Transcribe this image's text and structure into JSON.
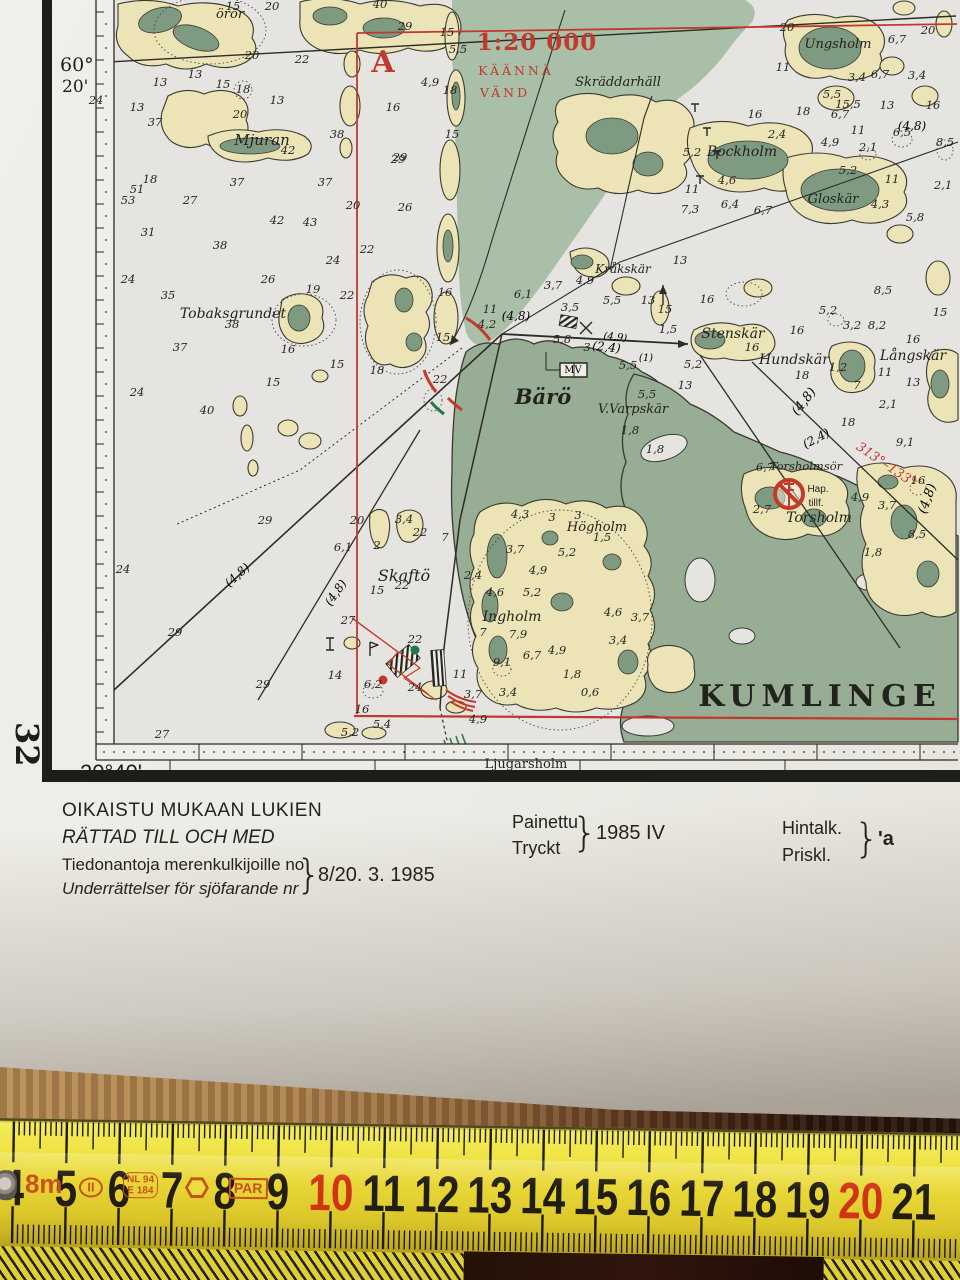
{
  "colors": {
    "chart_red": "#c0392e",
    "mark_red": "#c23b2a",
    "mark_green": "#1e7a4a",
    "land_cream": "#ece4b6",
    "shallow_green": "#a9bfa7",
    "land_green": "#97ae95",
    "tape_yellow": "#eedd3a"
  },
  "frame": {
    "lat_deg": "60°",
    "lat_min": "20'",
    "lon": "20°40'",
    "sheet": "32"
  },
  "map": {
    "places": [
      {
        "t": "örör",
        "x": 230,
        "y": 18,
        "s": 13
      },
      {
        "t": "Mjuran",
        "x": 262,
        "y": 145,
        "s": 15
      },
      {
        "t": "Tobaksgrundet",
        "x": 233,
        "y": 318,
        "s": 14
      },
      {
        "t": "Skräddarhäll",
        "x": 618,
        "y": 86,
        "s": 13
      },
      {
        "t": "Ungsholm",
        "x": 838,
        "y": 48,
        "s": 13
      },
      {
        "t": "Bockholm",
        "x": 742,
        "y": 156,
        "s": 14
      },
      {
        "t": "Gloskär",
        "x": 833,
        "y": 203,
        "s": 13
      },
      {
        "t": "Kråkskär",
        "x": 623,
        "y": 273,
        "s": 12
      },
      {
        "t": "Stenskär",
        "x": 733,
        "y": 338,
        "s": 14
      },
      {
        "t": "Hundskär",
        "x": 794,
        "y": 364,
        "s": 14
      },
      {
        "t": "Långskär",
        "x": 913,
        "y": 360,
        "s": 14
      },
      {
        "t": "Bärö",
        "x": 543,
        "y": 404,
        "s": 21,
        "b": 1
      },
      {
        "t": "V.Varpskär",
        "x": 633,
        "y": 413,
        "s": 13
      },
      {
        "t": "Torsholmsör",
        "x": 806,
        "y": 470,
        "s": 11.5
      },
      {
        "t": "Torsholm",
        "x": 819,
        "y": 522,
        "s": 14
      },
      {
        "t": "Hap.",
        "x": 818,
        "y": 492,
        "s": 10,
        "i": 0,
        "f": "sans"
      },
      {
        "t": "tillf.",
        "x": 816,
        "y": 506,
        "s": 10,
        "i": 0,
        "f": "sans"
      },
      {
        "t": "Skaftö",
        "x": 404,
        "y": 581,
        "s": 16
      },
      {
        "t": "Högholm",
        "x": 597,
        "y": 531,
        "s": 13
      },
      {
        "t": "Ingholm",
        "x": 512,
        "y": 621,
        "s": 14
      },
      {
        "t": "KUMLINGE",
        "x": 820,
        "y": 706,
        "s": 30,
        "b": 1,
        "i": 0,
        "ls": 6
      },
      {
        "t": "Ljugarsholm",
        "x": 526,
        "y": 768,
        "s": 13,
        "i": 0
      }
    ],
    "navs": [
      {
        "t": "1:20 000",
        "x": 537,
        "y": 50,
        "s": 23,
        "c": "red",
        "b": 1,
        "ls": 1
      },
      {
        "t": "KÄÄNNÄ",
        "x": 516,
        "y": 75,
        "s": 12.5,
        "c": "red",
        "ls": 3
      },
      {
        "t": "VÄND",
        "x": 505,
        "y": 97,
        "s": 12.5,
        "c": "red",
        "ls": 3
      },
      {
        "t": "A",
        "x": 383,
        "y": 72,
        "s": 30,
        "c": "red",
        "b": 1
      },
      {
        "t": "313°–133°",
        "x": 884,
        "y": 468,
        "s": 13,
        "c": "red",
        "r": 34,
        "i": 1
      },
      {
        "t": "(4,8)",
        "x": 516,
        "y": 320,
        "s": 12,
        "i": 1
      },
      {
        "t": "(4,8)",
        "x": 912,
        "y": 130,
        "s": 12,
        "i": 1
      },
      {
        "t": "(4,8)",
        "x": 240,
        "y": 578,
        "s": 12,
        "i": 1,
        "r": -42
      },
      {
        "t": "(4,8)",
        "x": 339,
        "y": 595,
        "s": 12,
        "i": 1,
        "r": -55
      },
      {
        "t": "(2,4)",
        "x": 606,
        "y": 351,
        "s": 12,
        "i": 1,
        "r": 6
      },
      {
        "t": "(4,9)",
        "x": 615,
        "y": 340,
        "s": 10,
        "i": 1,
        "r": 6
      },
      {
        "t": "(1)",
        "x": 646,
        "y": 361,
        "s": 10,
        "i": 1
      },
      {
        "t": "(2,4)",
        "x": 818,
        "y": 442,
        "s": 12,
        "i": 1,
        "r": -28
      },
      {
        "t": "(4,8)",
        "x": 807,
        "y": 404,
        "s": 13,
        "i": 1,
        "r": -52
      },
      {
        "t": "(4,8)",
        "x": 931,
        "y": 500,
        "s": 13,
        "i": 1,
        "r": -70
      },
      {
        "t": "MV",
        "x": 573,
        "y": 373,
        "s": 10,
        "i": 0
      }
    ],
    "depths": [
      [
        233,
        10,
        "15"
      ],
      [
        272,
        10,
        "20"
      ],
      [
        380,
        8,
        "40"
      ],
      [
        405,
        30,
        "29"
      ],
      [
        447,
        36,
        "15"
      ],
      [
        252,
        59,
        "20"
      ],
      [
        302,
        63,
        "22"
      ],
      [
        195,
        78,
        "13"
      ],
      [
        160,
        86,
        "13"
      ],
      [
        223,
        88,
        "15"
      ],
      [
        243,
        93,
        "18"
      ],
      [
        277,
        104,
        "13"
      ],
      [
        137,
        111,
        "13"
      ],
      [
        240,
        118,
        "20"
      ],
      [
        155,
        126,
        "37"
      ],
      [
        337,
        138,
        "38"
      ],
      [
        288,
        154,
        "42"
      ],
      [
        398,
        163,
        "29"
      ],
      [
        150,
        183,
        "18"
      ],
      [
        237,
        186,
        "37"
      ],
      [
        325,
        186,
        "37"
      ],
      [
        137,
        193,
        "51"
      ],
      [
        128,
        204,
        "53"
      ],
      [
        190,
        204,
        "27"
      ],
      [
        353,
        209,
        "20"
      ],
      [
        405,
        211,
        "26"
      ],
      [
        277,
        224,
        "42"
      ],
      [
        310,
        226,
        "43"
      ],
      [
        148,
        236,
        "31"
      ],
      [
        220,
        249,
        "38"
      ],
      [
        367,
        253,
        "22"
      ],
      [
        333,
        264,
        "24"
      ],
      [
        128,
        283,
        "24"
      ],
      [
        268,
        283,
        "26"
      ],
      [
        168,
        299,
        "35"
      ],
      [
        313,
        293,
        "19"
      ],
      [
        347,
        299,
        "22"
      ],
      [
        232,
        328,
        "38"
      ],
      [
        180,
        351,
        "37"
      ],
      [
        288,
        353,
        "16"
      ],
      [
        337,
        368,
        "15"
      ],
      [
        377,
        374,
        "18"
      ],
      [
        273,
        386,
        "15"
      ],
      [
        137,
        396,
        "24"
      ],
      [
        207,
        414,
        "40"
      ],
      [
        96,
        104,
        "24"
      ],
      [
        458,
        53,
        "5,5"
      ],
      [
        430,
        86,
        "4,9"
      ],
      [
        450,
        94,
        "18"
      ],
      [
        393,
        111,
        "16"
      ],
      [
        452,
        138,
        "15"
      ],
      [
        400,
        161,
        "29"
      ],
      [
        445,
        296,
        "16"
      ],
      [
        443,
        341,
        "15"
      ],
      [
        440,
        383,
        "22"
      ],
      [
        487,
        328,
        "4,2"
      ],
      [
        490,
        313,
        "11"
      ],
      [
        523,
        298,
        "6,1"
      ],
      [
        553,
        289,
        "3,7"
      ],
      [
        570,
        311,
        "3,5"
      ],
      [
        612,
        304,
        "5,5"
      ],
      [
        585,
        284,
        "4,9"
      ],
      [
        648,
        304,
        "13"
      ],
      [
        680,
        264,
        "13"
      ],
      [
        707,
        303,
        "16"
      ],
      [
        665,
        313,
        "15"
      ],
      [
        668,
        333,
        "1,5"
      ],
      [
        587,
        351,
        "3"
      ],
      [
        562,
        343,
        "5,8"
      ],
      [
        628,
        369,
        "5,5"
      ],
      [
        693,
        368,
        "5,2"
      ],
      [
        685,
        389,
        "13"
      ],
      [
        647,
        398,
        "5,5"
      ],
      [
        630,
        434,
        "1,8"
      ],
      [
        655,
        453,
        "1,8"
      ],
      [
        787,
        31,
        "20"
      ],
      [
        928,
        34,
        "20"
      ],
      [
        897,
        43,
        "6,7"
      ],
      [
        783,
        71,
        "11"
      ],
      [
        857,
        81,
        "3,4"
      ],
      [
        880,
        78,
        "6,7"
      ],
      [
        917,
        79,
        "3,4"
      ],
      [
        832,
        98,
        "5,5"
      ],
      [
        848,
        108,
        "15,5"
      ],
      [
        887,
        109,
        "13"
      ],
      [
        933,
        109,
        "16"
      ],
      [
        755,
        118,
        "16"
      ],
      [
        803,
        115,
        "18"
      ],
      [
        840,
        118,
        "6,7"
      ],
      [
        858,
        134,
        "11"
      ],
      [
        902,
        136,
        "6,5"
      ],
      [
        945,
        146,
        "8,5"
      ],
      [
        777,
        138,
        "2,4"
      ],
      [
        830,
        146,
        "4,9"
      ],
      [
        868,
        151,
        "2,1"
      ],
      [
        692,
        156,
        "5,2"
      ],
      [
        848,
        174,
        "5,2"
      ],
      [
        892,
        183,
        "11"
      ],
      [
        727,
        184,
        "4,6"
      ],
      [
        692,
        193,
        "11"
      ],
      [
        730,
        208,
        "6,4"
      ],
      [
        763,
        214,
        "6,7"
      ],
      [
        880,
        208,
        "4,3"
      ],
      [
        943,
        189,
        "2,1"
      ],
      [
        690,
        213,
        "7,3"
      ],
      [
        915,
        221,
        "5,8"
      ],
      [
        883,
        294,
        "8,5"
      ],
      [
        828,
        314,
        "5,2"
      ],
      [
        852,
        329,
        "3,2"
      ],
      [
        877,
        329,
        "8,2"
      ],
      [
        940,
        316,
        "15"
      ],
      [
        913,
        343,
        "16"
      ],
      [
        797,
        334,
        "16"
      ],
      [
        752,
        351,
        "16"
      ],
      [
        838,
        371,
        "1,2"
      ],
      [
        885,
        376,
        "11"
      ],
      [
        913,
        386,
        "13"
      ],
      [
        857,
        389,
        "7"
      ],
      [
        802,
        379,
        "18"
      ],
      [
        888,
        408,
        "2,1"
      ],
      [
        848,
        426,
        "18"
      ],
      [
        905,
        446,
        "9,1"
      ],
      [
        918,
        484,
        "16"
      ],
      [
        762,
        513,
        "2,7"
      ],
      [
        860,
        501,
        "4,9"
      ],
      [
        887,
        509,
        "3,7"
      ],
      [
        917,
        538,
        "8,5"
      ],
      [
        873,
        556,
        "1,8"
      ],
      [
        765,
        471,
        "6,7"
      ],
      [
        357,
        524,
        "20"
      ],
      [
        420,
        536,
        "22"
      ],
      [
        404,
        523,
        "3,4"
      ],
      [
        377,
        549,
        "2"
      ],
      [
        343,
        551,
        "6,1"
      ],
      [
        377,
        594,
        "15"
      ],
      [
        402,
        589,
        "22"
      ],
      [
        348,
        624,
        "27"
      ],
      [
        445,
        541,
        "7"
      ],
      [
        473,
        579,
        "2,4"
      ],
      [
        495,
        596,
        "4,6"
      ],
      [
        532,
        596,
        "5,2"
      ],
      [
        538,
        574,
        "4,9"
      ],
      [
        515,
        553,
        "3,7"
      ],
      [
        520,
        518,
        "4,3"
      ],
      [
        552,
        521,
        "3"
      ],
      [
        578,
        519,
        "3"
      ],
      [
        602,
        541,
        "1,5"
      ],
      [
        567,
        556,
        "5,2"
      ],
      [
        483,
        636,
        "7"
      ],
      [
        518,
        638,
        "7,9"
      ],
      [
        557,
        654,
        "4,9"
      ],
      [
        532,
        659,
        "6,7"
      ],
      [
        502,
        666,
        "9,1"
      ],
      [
        460,
        678,
        "11"
      ],
      [
        415,
        643,
        "22"
      ],
      [
        415,
        691,
        "24"
      ],
      [
        373,
        688,
        "6,2"
      ],
      [
        335,
        679,
        "14"
      ],
      [
        508,
        696,
        "3,4"
      ],
      [
        640,
        621,
        "3,7"
      ],
      [
        613,
        616,
        "4,6"
      ],
      [
        618,
        644,
        "3,4"
      ],
      [
        572,
        678,
        "1,8"
      ],
      [
        590,
        696,
        "0,6"
      ],
      [
        263,
        688,
        "29"
      ],
      [
        162,
        738,
        "27"
      ],
      [
        362,
        713,
        "16"
      ],
      [
        382,
        728,
        "5,4"
      ],
      [
        350,
        736,
        "5,2"
      ],
      [
        478,
        723,
        "4,9"
      ],
      [
        473,
        698,
        "3,7"
      ],
      [
        265,
        524,
        "29"
      ],
      [
        123,
        573,
        "24"
      ],
      [
        175,
        636,
        "29"
      ]
    ]
  },
  "footer": {
    "corrected_fi": "OIKAISTU MUKAAN LUKIEN",
    "corrected_sv": "RÄTTAD TILL OCH MED",
    "notices_fi": "Tiedonantoja merenkulkijoille no",
    "notices_sv": "Underrättelser för sjöfarande nr",
    "brace": "}",
    "notices_value": "8/20. 3. 1985",
    "printed_fi": "Painettu",
    "printed_sv": "Tryckt",
    "printed_value": "1985  IV",
    "price_fi": "Hintalk.",
    "price_sv": "Priskl.",
    "price_value": "'a"
  },
  "ruler": {
    "numbers": [
      {
        "v": "4"
      },
      {
        "v": "5"
      },
      {
        "v": "6"
      },
      {
        "v": "7"
      },
      {
        "v": "8"
      },
      {
        "v": "9"
      },
      {
        "v": "10",
        "red": true
      },
      {
        "v": "11"
      },
      {
        "v": "12"
      },
      {
        "v": "13"
      },
      {
        "v": "14"
      },
      {
        "v": "15"
      },
      {
        "v": "16"
      },
      {
        "v": "17"
      },
      {
        "v": "18"
      },
      {
        "v": "19"
      },
      {
        "v": "20",
        "red": true
      },
      {
        "v": "21"
      }
    ],
    "unit_label": "8m",
    "class_label": "II",
    "cert_label_1": "NL 94",
    "cert_label_2": "E 184",
    "brand_label": "PAR"
  }
}
